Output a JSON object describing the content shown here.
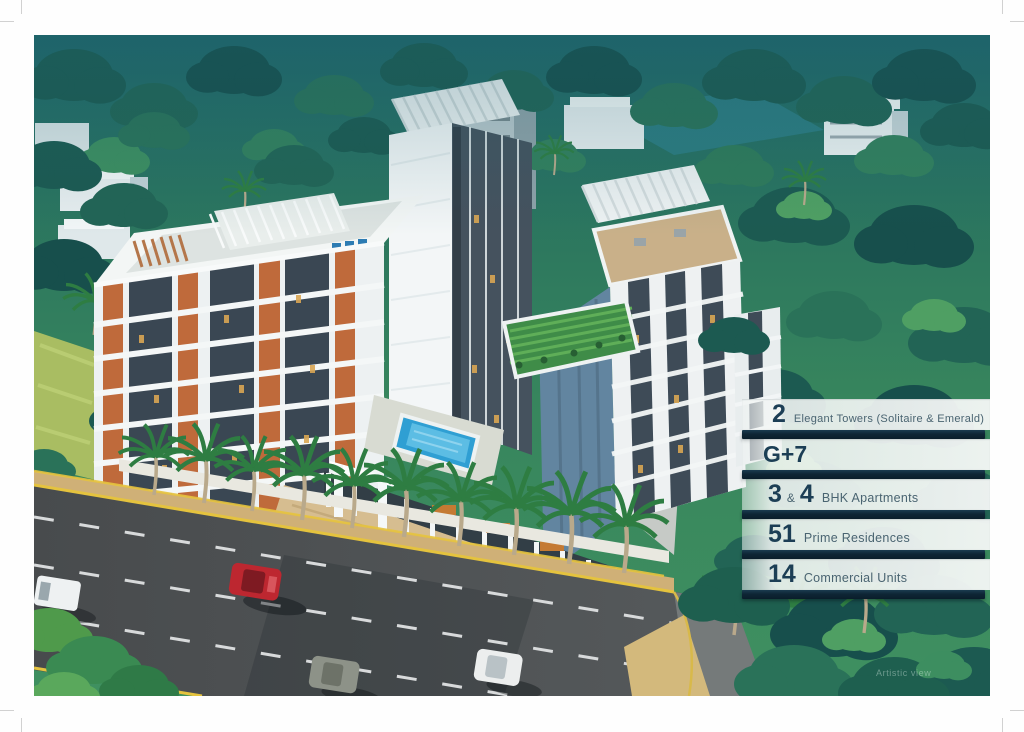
{
  "document": {
    "type": "real-estate-brochure-page",
    "watermark": "Artistic view"
  },
  "palette": {
    "panel_band": "#f3f6f5",
    "panel_separator": "#0e2635",
    "number_color": "#1c3e55",
    "label_color": "#4a6471",
    "foliage_dark": "#174f4c",
    "foliage_mid": "#33805d",
    "foliage_light": "#66b169",
    "building_white": "#eff3f4",
    "building_slate": "#3a4753",
    "building_brick": "#bf6a3b",
    "road_asphalt": "#4c5052",
    "road_marking_yellow": "#e5c33e",
    "pool_blue": "#2f9fd3"
  },
  "feature_panel": {
    "rows": [
      {
        "number": "2",
        "label": "Elegant Towers (Solitaire & Emerald)"
      },
      {
        "number": "G+7",
        "label": ""
      },
      {
        "number": "3",
        "amp": "&",
        "number2": "4",
        "label": "BHK Apartments"
      },
      {
        "number": "51",
        "label": "Prime Residences"
      },
      {
        "number": "14",
        "label": "Commercial Units"
      }
    ]
  }
}
